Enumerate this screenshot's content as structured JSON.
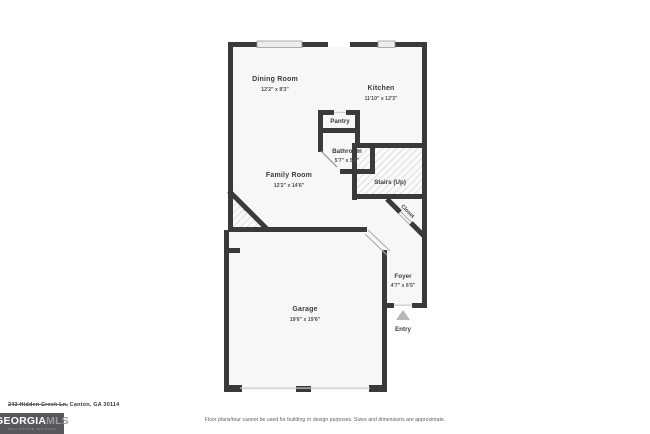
{
  "floor_plan": {
    "rooms": {
      "dining": {
        "name": "Dining Room",
        "dims": "12'2\" x 8'3\""
      },
      "kitchen": {
        "name": "Kitchen",
        "dims": "11'10\" x 12'3\""
      },
      "pantry": {
        "name": "Pantry"
      },
      "bathroom": {
        "name": "Bathroom",
        "dims": "5'7\" x 5'4\""
      },
      "family": {
        "name": "Family Room",
        "dims": "12'2\" x 14'6\""
      },
      "stairs": {
        "name": "Stairs (Up)"
      },
      "closet": {
        "name": "Closet"
      },
      "fireplace": {
        "name": "Fireplace"
      },
      "garage": {
        "name": "Garage",
        "dims": "19'6\" x 19'6\""
      },
      "foyer": {
        "name": "Foyer",
        "dims": "4'7\" x 6'5\""
      },
      "entry": {
        "name": "Entry"
      }
    }
  },
  "footer": {
    "address_struck": "243 Hidden Creek Ln,",
    "address_rest": " Canton, GA 30114",
    "disclaimer": "Floor plans/tour cannot be used for building or design purposes. Sizes and dimensions are approximate.",
    "logo": {
      "primary": "GEORGIA",
      "secondary": "MLS",
      "tagline": "REAL ESTATE SERVICES"
    }
  },
  "colors": {
    "wall": "#3a3a3a",
    "floor": "#f7f7f7",
    "hatch_line": "#cfcfcf",
    "window_fill": "#ececec",
    "entry_arrow": "#b8b8b8",
    "logo_bg": "#57585b"
  }
}
